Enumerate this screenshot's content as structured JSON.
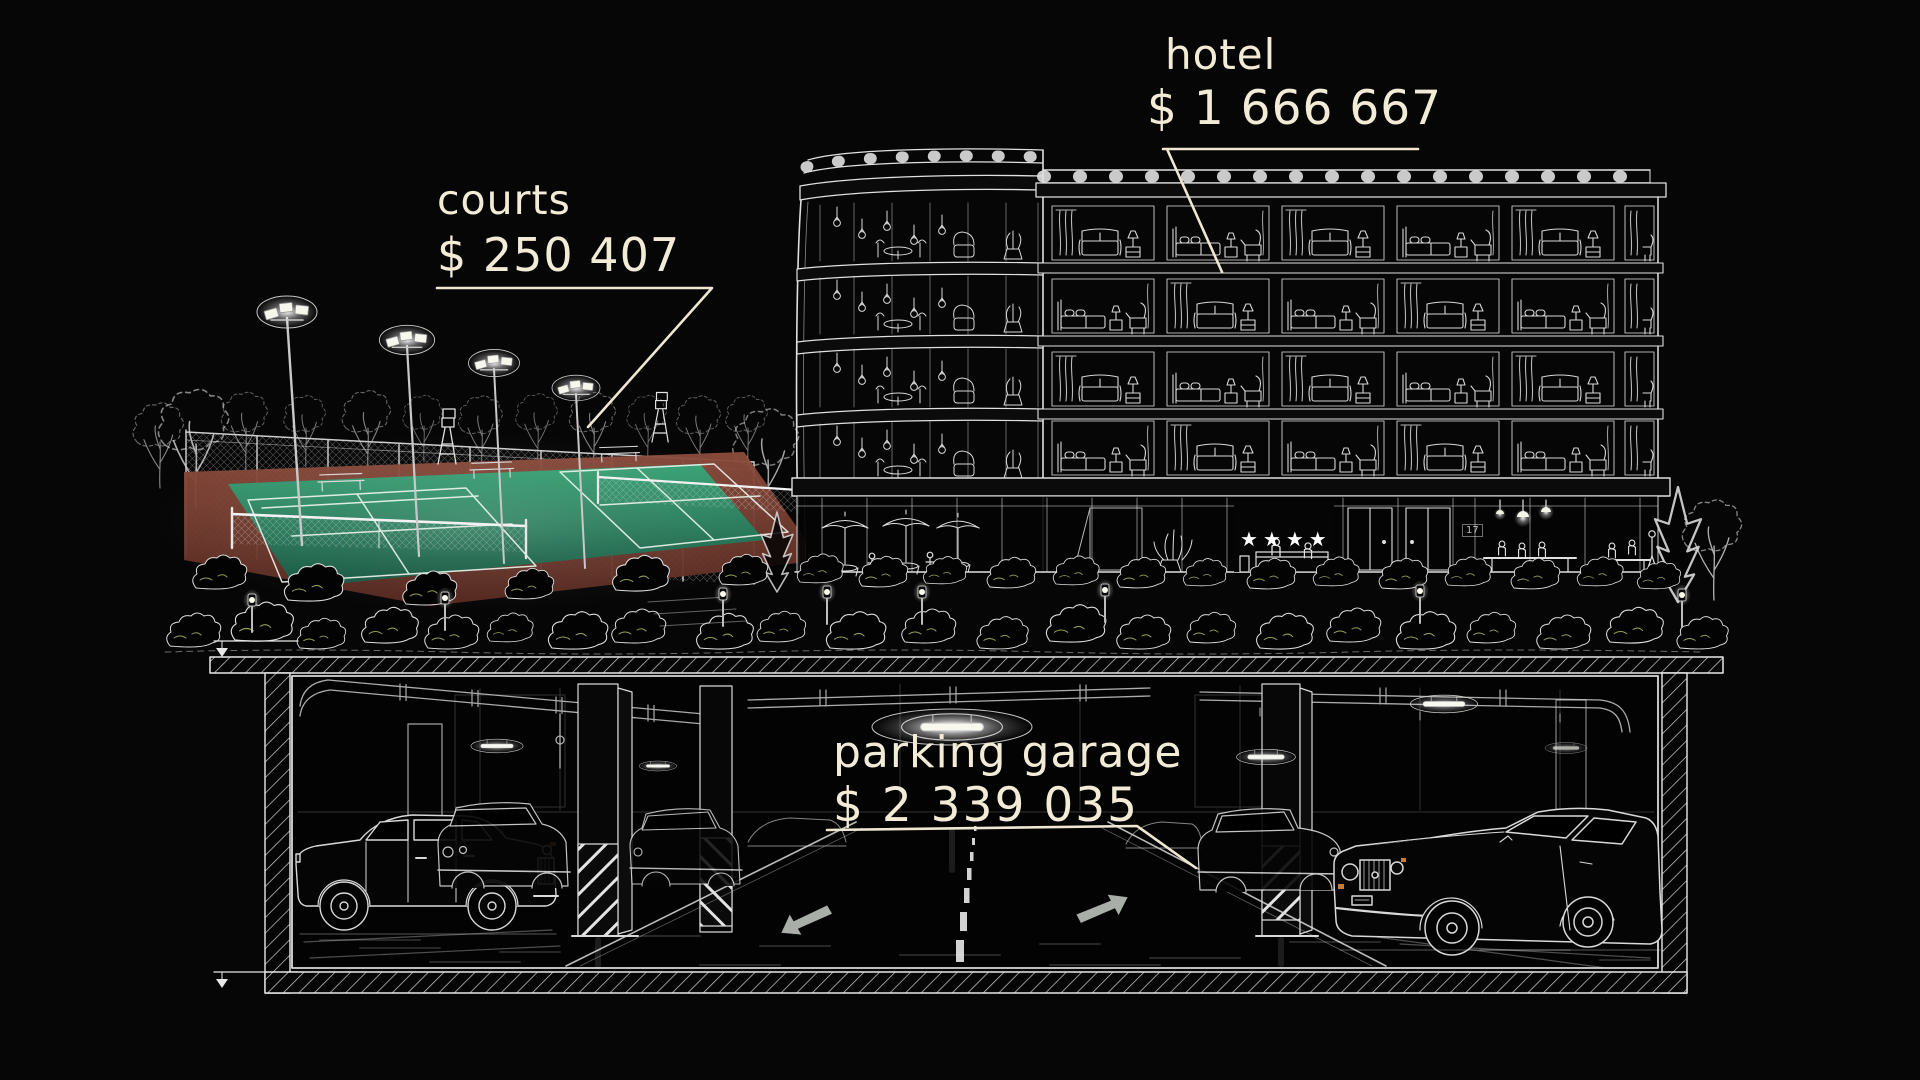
{
  "labels": {
    "courts": {
      "title": "courts",
      "price": "$ 250 407"
    },
    "hotel": {
      "title": "hotel",
      "price": "$ 1 666 667"
    },
    "parking": {
      "title": "parking garage",
      "price": "$ 2 339 035"
    }
  },
  "hotel_front": {
    "stars_glyph": "★★★★",
    "stars_count": 4,
    "wall_sign": "17"
  },
  "colors": {
    "background": "#060606",
    "label_text": "#f2ebd6",
    "leader_line": "#efe7d0",
    "line_art": "#dedede",
    "court_green": "#2f8f6b",
    "court_surround": "#7c4034",
    "bush_fleck": "#b9c467",
    "hazard_stripe": "#e3e3e3",
    "arrow_gray": "#b2b8b2",
    "amber_light": "#c97b3a",
    "star_white": "#ffffff"
  }
}
